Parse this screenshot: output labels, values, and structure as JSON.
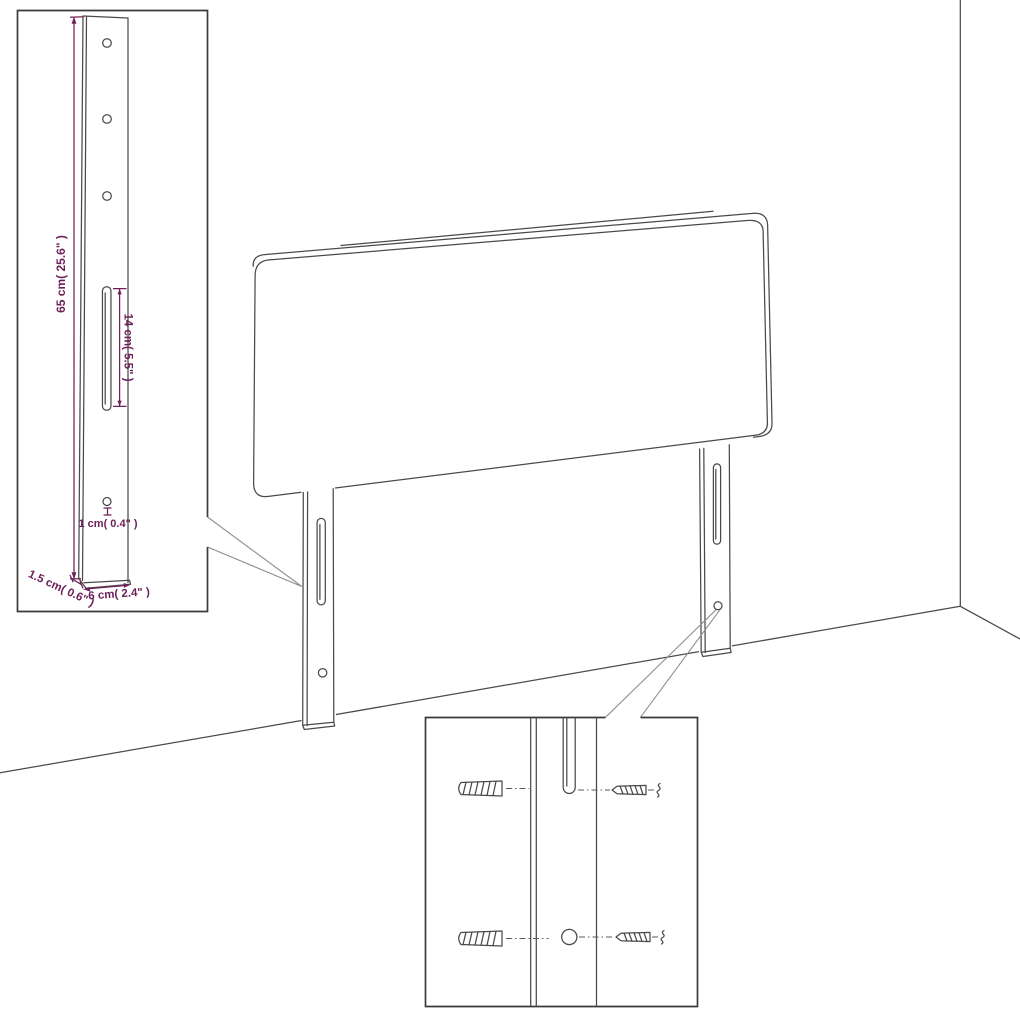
{
  "colors": {
    "background": "#ffffff",
    "drawing_line": "#4a4a4a",
    "inset_border": "#3a3a3a",
    "callout_line": "#8f8f8f",
    "dimension": "#6e2058"
  },
  "leg_detail_inset": {
    "labels": {
      "height": "65 cm( 25.6\" )",
      "slot": "14 cm( 5.5\" )",
      "hole": "1 cm( 0.4\" )",
      "thickness": "1.5 cm( 0.6\" )",
      "width": "6 cm( 2.4\" )"
    }
  }
}
